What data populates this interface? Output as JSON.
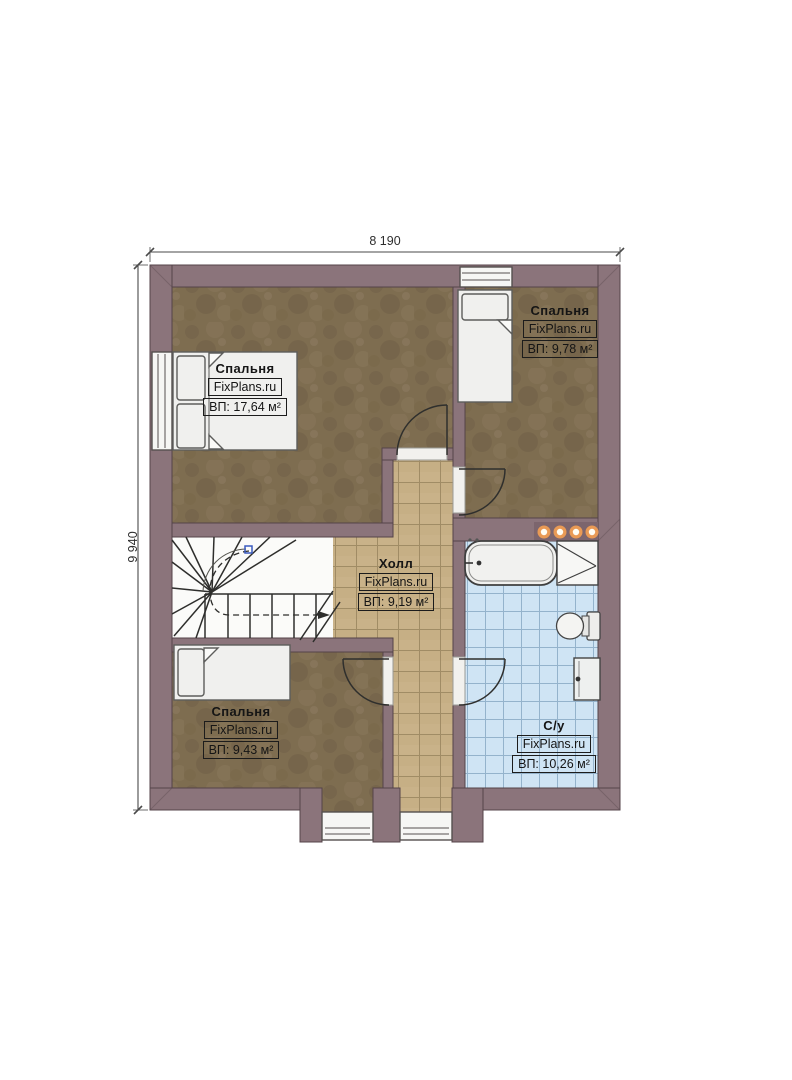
{
  "plan": {
    "type": "floor-plan",
    "dimensions": {
      "width_label": "8 190",
      "height_label": "9 940"
    },
    "rooms": [
      {
        "id": "bedroom-top-left",
        "name": "Спальня",
        "watermark": "FixPlans.ru",
        "area": "ВП: 17,64 м²"
      },
      {
        "id": "bedroom-top-right",
        "name": "Спальня",
        "watermark": "FixPlans.ru",
        "area": "ВП: 9,78 м²"
      },
      {
        "id": "hall",
        "name": "Холл",
        "watermark": "FixPlans.ru",
        "area": "ВП: 9,19 м²"
      },
      {
        "id": "bedroom-bottom-left",
        "name": "Спальня",
        "watermark": "FixPlans.ru",
        "area": "ВП: 9,43 м²"
      },
      {
        "id": "bathroom",
        "name": "С/у",
        "watermark": "FixPlans.ru",
        "area": "ВП: 10,26 м²"
      }
    ],
    "colors": {
      "wall": "#8b747b",
      "wood_floor": "#7e6d50",
      "hall_tile": "#c9b289",
      "bath_tile": "#cfe4f4",
      "spotlight": "#e99a55"
    }
  }
}
